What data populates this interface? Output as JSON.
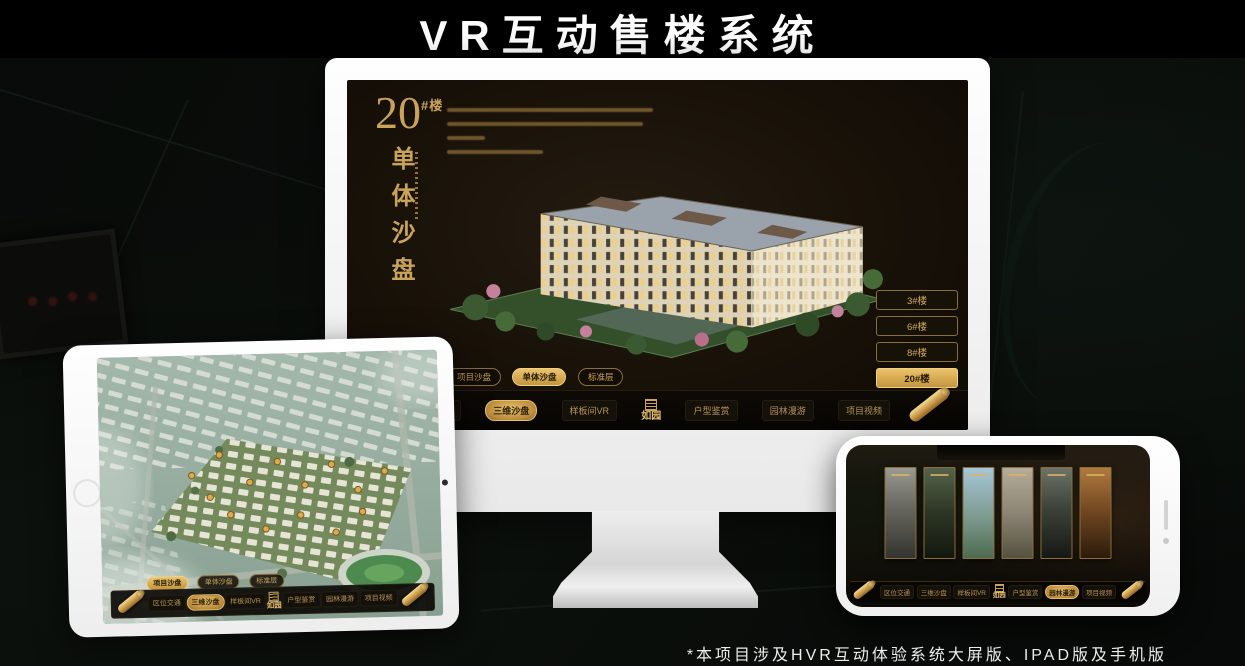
{
  "page": {
    "title": "VR互动售楼系统",
    "footnote": "*本项目涉及HVR互动体验系统大屏版、IPAD版及手机版"
  },
  "colors": {
    "gold": "#d4a85c",
    "gold_bright": "#ecc36a",
    "gold_deep": "#8a6426",
    "screen_bg": "#171209",
    "device_frame": "#f5f5f4"
  },
  "monitor": {
    "building_number": "20",
    "building_number_suffix": "#楼",
    "vertical_title": "单体沙盘",
    "floor_buttons": [
      "3#楼",
      "6#楼",
      "8#楼",
      "20#楼"
    ],
    "selected_floor": "20#楼",
    "sub_tabs": [
      "项目沙盘",
      "单体沙盘",
      "标准层"
    ],
    "selected_sub_tab": "单体沙盘",
    "menu": [
      "区位交通",
      "三维沙盘",
      "样板间VR",
      "户型鉴赏",
      "园林漫游",
      "项目视频"
    ],
    "selected_menu": "三维沙盘",
    "logo": "如园"
  },
  "tablet": {
    "sub_tabs": [
      "项目沙盘",
      "单体沙盘",
      "标准层"
    ],
    "selected_sub_tab": "项目沙盘",
    "menu": [
      "区位交通",
      "三维沙盘",
      "样板间VR",
      "户型鉴赏",
      "园林漫游",
      "项目视频"
    ],
    "selected_menu": "三维沙盘",
    "logo": "如园"
  },
  "phone": {
    "menu": [
      "区位交通",
      "三维沙盘",
      "样板间VR",
      "户型鉴赏",
      "园林漫游",
      "项目视频"
    ],
    "selected_menu": "园林漫游",
    "logo": "如园"
  }
}
